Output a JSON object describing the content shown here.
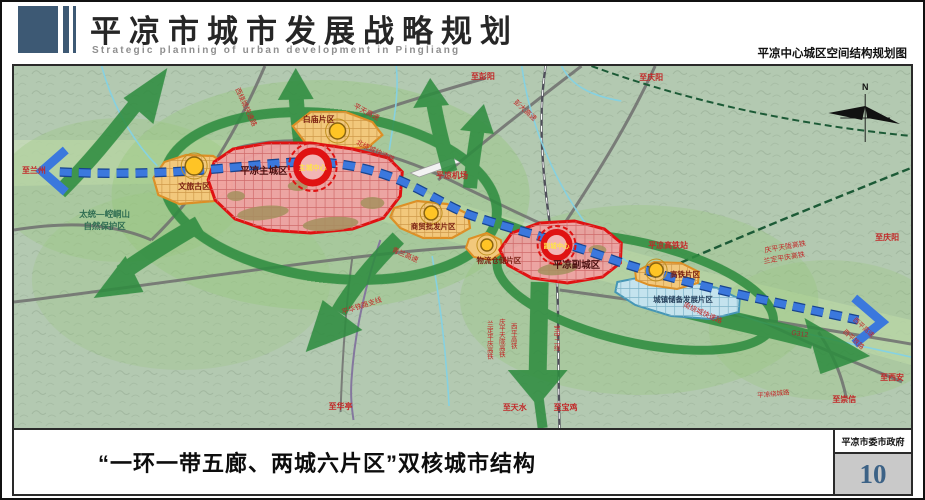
{
  "page": {
    "header": {
      "title": "平凉市城市发展战略规划",
      "subtitle_en": "Strategic planning of urban development in Pingliang",
      "map_title": "平凉中心城区空间结构规划图"
    },
    "footer": {
      "caption": "“一环一带五廊、两城六片区”双核城市结构",
      "gov_label": "平凉市委市政府",
      "page_number": "10"
    }
  },
  "colors": {
    "district_red_fill": "#efa2a2",
    "district_red_border": "#e01212",
    "district_orange_fill": "#f2c87c",
    "district_orange_border": "#dd8f25",
    "district_blue_fill": "#c4e3ee",
    "district_blue_border": "#4596b5",
    "axis_blue": "#3b78dd",
    "corridor_green": "#2f8c40",
    "node_yellow": "#ffc425",
    "label_red": "#c22727",
    "page_number_blue": "#3c6286"
  },
  "map": {
    "labels": [
      {
        "id": "to-lanzhou",
        "text": "至兰州",
        "x": 32,
        "y": 173,
        "size": 8,
        "bold": true
      },
      {
        "id": "nature-reserve-1",
        "text": "太统—崆峒山",
        "x": 103,
        "y": 217,
        "color": "#2f6d52",
        "size": 8.5,
        "bold": true
      },
      {
        "id": "nature-reserve-2",
        "text": "自然保护区",
        "x": 103,
        "y": 229,
        "color": "#2f6d52",
        "size": 8.5,
        "bold": true
      },
      {
        "id": "west-ring-expwy",
        "text": "西绕城快速路",
        "x": 243,
        "y": 108,
        "rot": 65,
        "size": 7
      },
      {
        "id": "baimiao-district",
        "text": "白庙片区",
        "x": 318,
        "y": 122,
        "color": "#7a1f12",
        "size": 8,
        "bold": true
      },
      {
        "id": "pingtian-expwy",
        "text": "平天高速",
        "x": 365,
        "y": 114,
        "rot": 28,
        "size": 7
      },
      {
        "id": "north-ring-expwy",
        "text": "北绕城快速路",
        "x": 374,
        "y": 153,
        "rot": 26,
        "size": 7
      },
      {
        "id": "to-pengyang",
        "text": "至彭阳",
        "x": 483,
        "y": 79,
        "size": 8,
        "bold": true
      },
      {
        "id": "pengda-expwy",
        "text": "彭大高速",
        "x": 524,
        "y": 112,
        "rot": 42,
        "size": 7
      },
      {
        "id": "to-qingyang-top",
        "text": "至庆阳",
        "x": 652,
        "y": 80,
        "size": 8,
        "bold": true
      },
      {
        "id": "pingliang-airport",
        "text": "平凉机场",
        "x": 452,
        "y": 178,
        "size": 8,
        "bold": true
      },
      {
        "id": "wenlv-guqu",
        "text": "文旅古区",
        "x": 193,
        "y": 189,
        "color": "#7a1f12",
        "size": 8,
        "bold": true
      },
      {
        "id": "main-city",
        "text": "平凉主城区",
        "x": 263,
        "y": 174,
        "color": "#4a1010",
        "size": 9.5,
        "bold": true
      },
      {
        "id": "main-center",
        "text": "主城中心",
        "x": 312,
        "y": 170,
        "color": "#ffe34a",
        "size": 7,
        "bold": true
      },
      {
        "id": "qinglan-expwy",
        "text": "青兰高速",
        "x": 404,
        "y": 257,
        "rot": 23,
        "size": 7
      },
      {
        "id": "shangmao-district",
        "text": "商贸批发片区",
        "x": 433,
        "y": 229,
        "color": "#7a1f12",
        "size": 7.5,
        "bold": true
      },
      {
        "id": "wuliu-district",
        "text": "物流仓储片区",
        "x": 499,
        "y": 263,
        "color": "#7a1f12",
        "size": 7.5,
        "bold": true
      },
      {
        "id": "sub-city",
        "text": "平凉副城区",
        "x": 577,
        "y": 268,
        "color": "#4a1010",
        "size": 9.5,
        "bold": true
      },
      {
        "id": "sub-center",
        "text": "副城中心",
        "x": 557,
        "y": 248,
        "color": "#ffe34a",
        "size": 6.5,
        "bold": true
      },
      {
        "id": "pinghua-railway",
        "text": "平华铁路支线",
        "x": 362,
        "y": 308,
        "rot": -18,
        "size": 7
      },
      {
        "id": "to-huating",
        "text": "至华亭",
        "x": 340,
        "y": 409,
        "size": 8,
        "bold": true
      },
      {
        "id": "landing-hsr-v",
        "text": "兰定平庆高铁",
        "x": 489,
        "y": 340,
        "vertical": true,
        "size": 6.5
      },
      {
        "id": "qingping-hsr-v",
        "text": "庆平天陇高铁",
        "x": 501,
        "y": 338,
        "vertical": true,
        "size": 6.5
      },
      {
        "id": "xiping-hsr-v",
        "text": "西平高铁",
        "x": 513,
        "y": 336,
        "vertical": true,
        "size": 6.5
      },
      {
        "id": "baozhong-line-v",
        "text": "宝中二线",
        "x": 556,
        "y": 338,
        "vertical": true,
        "size": 6.5
      },
      {
        "id": "to-tianshui",
        "text": "至天水",
        "x": 515,
        "y": 410,
        "size": 8,
        "bold": true
      },
      {
        "id": "to-baoji",
        "text": "至宝鸡",
        "x": 566,
        "y": 410,
        "size": 8,
        "bold": true
      },
      {
        "id": "hsr-station",
        "text": "平凉高铁站",
        "x": 669,
        "y": 248,
        "size": 8,
        "bold": true
      },
      {
        "id": "gaotie-district",
        "text": "高铁片区",
        "x": 686,
        "y": 277,
        "color": "#7a1f12",
        "size": 7.5,
        "bold": true
      },
      {
        "id": "reserve-district",
        "text": "城镇储备发展片区",
        "x": 684,
        "y": 302,
        "color": "#27415c",
        "size": 7.5,
        "bold": true
      },
      {
        "id": "south-ring-expwy",
        "text": "南绕城快速路",
        "x": 703,
        "y": 315,
        "rot": 24,
        "size": 7
      },
      {
        "id": "qingping-hsr",
        "text": "庆平天陇高铁",
        "x": 787,
        "y": 249,
        "rot": -10,
        "size": 7
      },
      {
        "id": "landing-hsr",
        "text": "兰定平庆高铁",
        "x": 786,
        "y": 260,
        "rot": -10,
        "size": 7
      },
      {
        "id": "to-qingyang-right",
        "text": "至庆阳",
        "x": 889,
        "y": 240,
        "size": 8,
        "bold": true
      },
      {
        "id": "g312",
        "text": "G312",
        "x": 801,
        "y": 336,
        "rot": 8,
        "size": 7,
        "color": "#a03030"
      },
      {
        "id": "xiping-expwy",
        "text": "西平高速",
        "x": 864,
        "y": 329,
        "rot": 42,
        "size": 6.5
      },
      {
        "id": "xiping-railway",
        "text": "西平铁路",
        "x": 854,
        "y": 341,
        "rot": 42,
        "size": 6.5
      },
      {
        "id": "to-xian",
        "text": "至西安",
        "x": 894,
        "y": 380,
        "size": 8,
        "bold": true
      },
      {
        "id": "to-chongxin",
        "text": "至崇信",
        "x": 846,
        "y": 402,
        "size": 8,
        "bold": true
      },
      {
        "id": "ring-road",
        "text": "平凉绕城路",
        "x": 775,
        "y": 396,
        "rot": -6,
        "size": 6.5
      },
      {
        "id": "compass-n",
        "text": "N",
        "x": 867,
        "y": 90,
        "color": "#111111",
        "size": 9,
        "bold": true
      }
    ]
  }
}
